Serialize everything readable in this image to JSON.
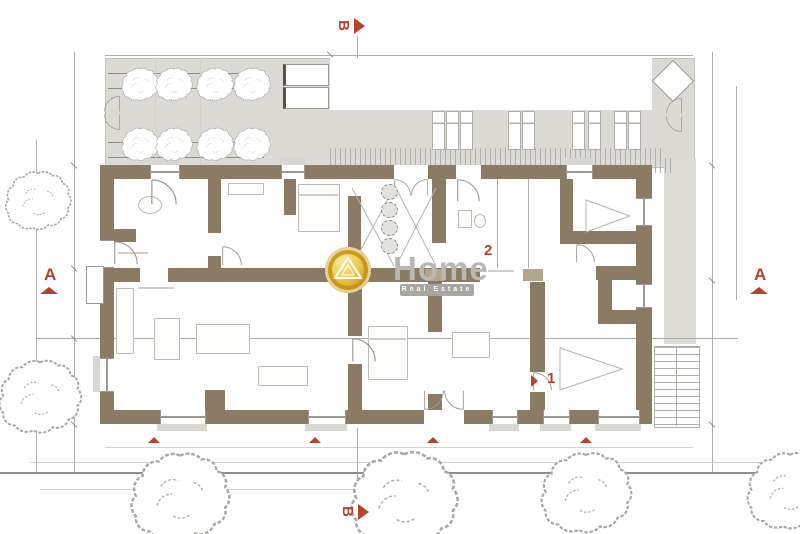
{
  "document": {
    "type": "architectural floor plan"
  },
  "markers": {
    "section_a_left": "A",
    "section_a_right": "A",
    "section_b_top": "B",
    "section_b_bottom": "B"
  },
  "annotations": {
    "label_1": "1",
    "label_2": "2"
  },
  "watermark": {
    "brand": "Home",
    "tagline": "Real Estate"
  },
  "colors": {
    "wall": "#8c7b64",
    "terrace": "#dbdad4",
    "accent_red": "#b5432e",
    "logo_gold": "#d8a82a",
    "sketch_grey": "#a9a8a2"
  }
}
